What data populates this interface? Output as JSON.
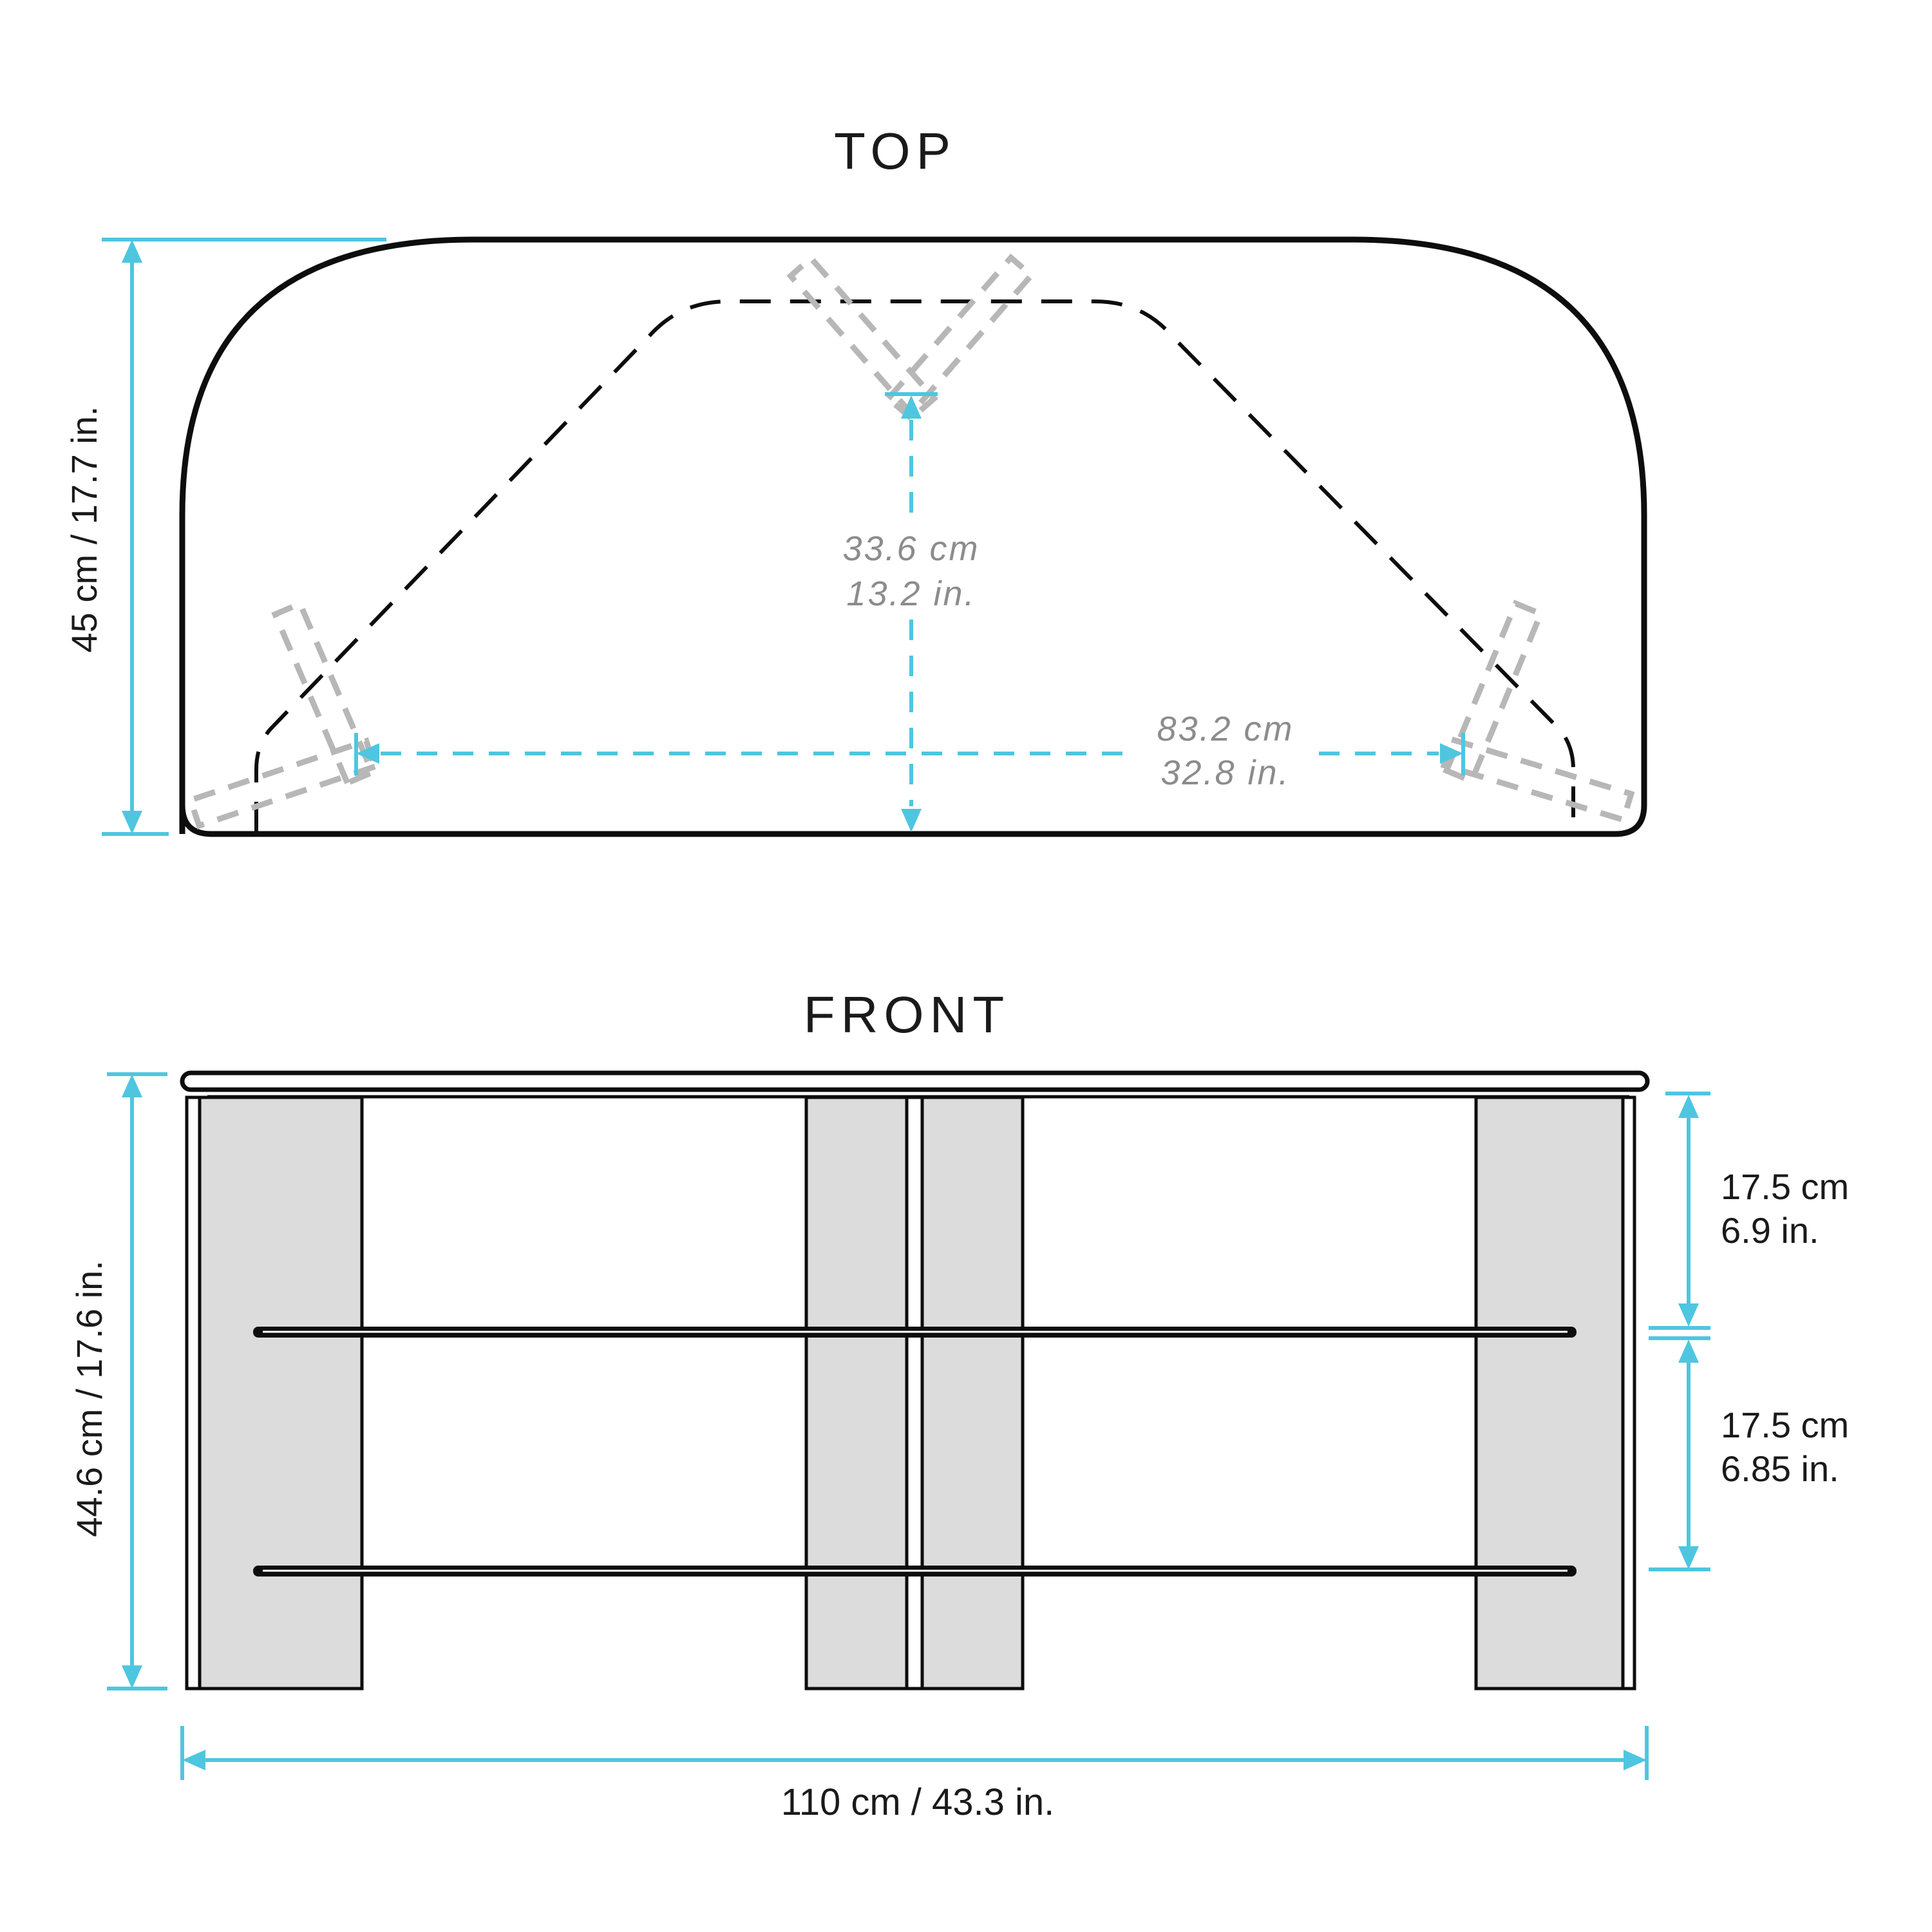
{
  "colors": {
    "accent": "#4EC6E0",
    "line": "#0d0d0d",
    "ink": "#1a1a1a",
    "muted": "#8c8c8c",
    "panel": "#dcdcdc",
    "bracket": "#b7b7b7"
  },
  "top_view": {
    "title": "TOP",
    "depth_label": "45 cm / 17.7 in.",
    "inner_depth": {
      "cm": "33.6 cm",
      "in": "13.2 in."
    },
    "inner_width": {
      "cm": "83.2 cm",
      "in": "32.8 in."
    }
  },
  "front_view": {
    "title": "FRONT",
    "height_label": "44.6 cm / 17.6 in.",
    "upper_gap": {
      "cm": "17.5 cm",
      "in": "6.9 in."
    },
    "lower_gap": {
      "cm": "17.5 cm",
      "in": "6.85 in."
    },
    "width_label": "110 cm / 43.3 in."
  }
}
